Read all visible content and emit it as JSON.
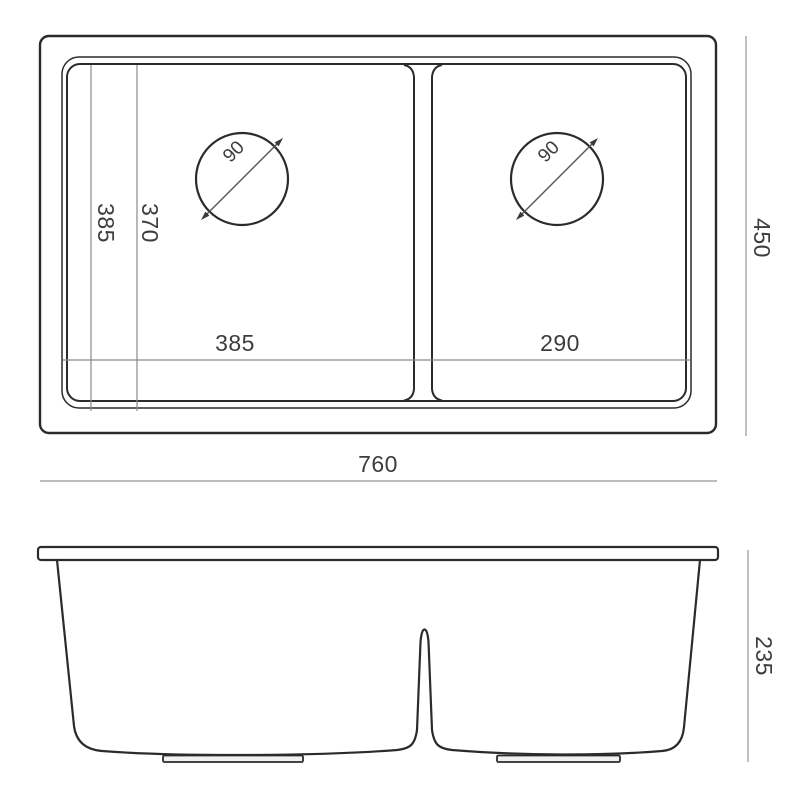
{
  "diagram": {
    "colors": {
      "background": "#ffffff",
      "outline": "#2b2b2b",
      "dimension_line": "#a6a6a6",
      "extension_line": "#8a8a8a",
      "text": "#3d3d3d"
    },
    "top_view": {
      "labels": {
        "overall_width": "760",
        "overall_depth": "450",
        "bowl_length": "385",
        "bowl_inner_length": "370",
        "left_bowl_width": "385",
        "right_bowl_width": "290",
        "left_drain_diameter": "90",
        "right_drain_diameter": "90"
      }
    },
    "front_view": {
      "labels": {
        "overall_height": "235"
      }
    }
  }
}
